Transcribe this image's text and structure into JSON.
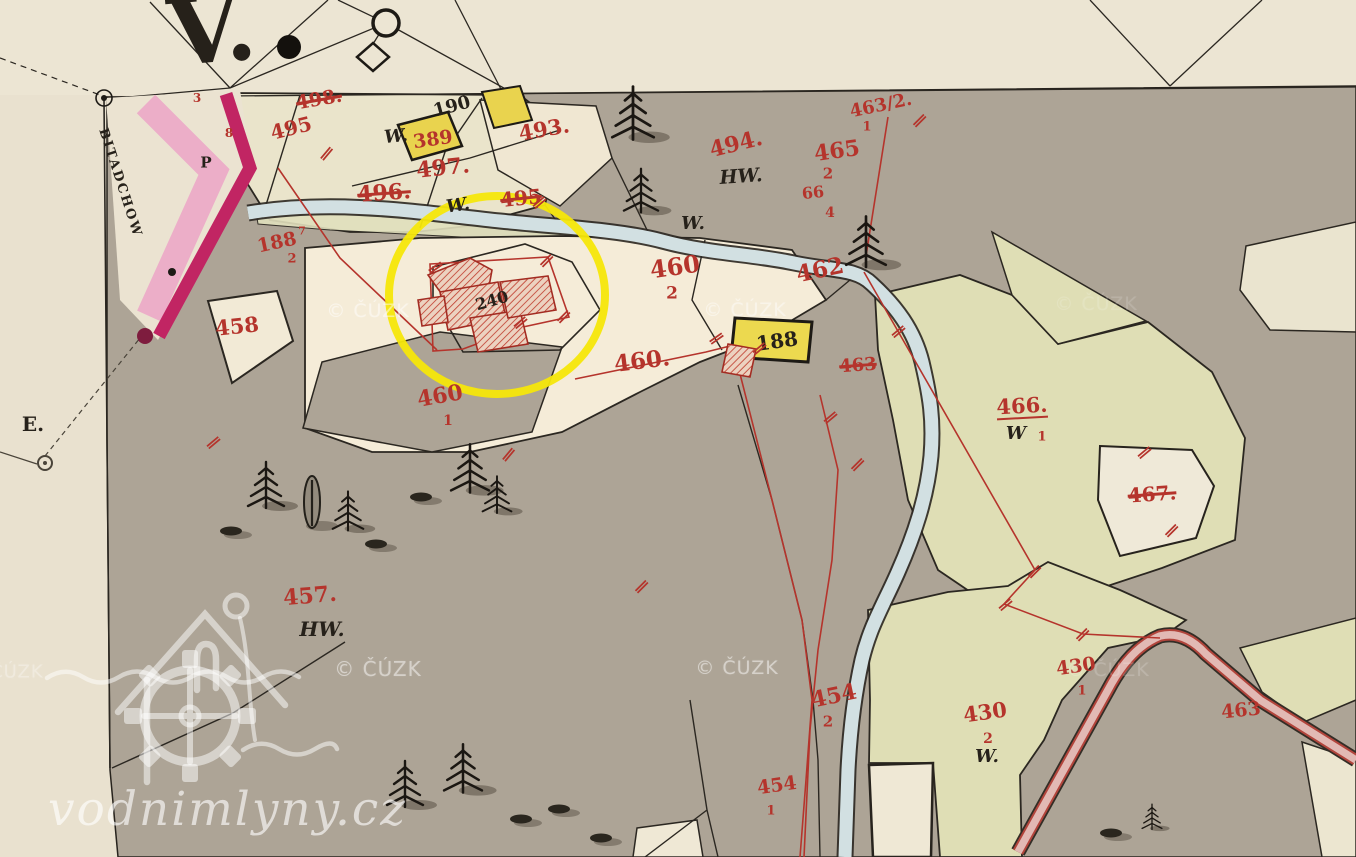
{
  "map": {
    "title": "historic cadastral map sheet",
    "palette": {
      "paper": "#e9e1cf",
      "forest_gray": "#ada496",
      "parcel_cream": "#f5ecd8",
      "parcel_olive": "#dfdeb5",
      "stream_blue": "#d2e0e2",
      "road_pink": "#ecaec8",
      "road_magenta": "#c12563",
      "building_yellow": "#e9d34e",
      "ink_red": "#b5342c",
      "ink_black": "#26211a",
      "highlight_yellow": "#f6e70a"
    },
    "highlight_circle": {
      "cx": 497,
      "cy": 295,
      "rx": 108,
      "ry": 99
    },
    "watermarks": {
      "cuzk_text": "© ČÚZK",
      "site": "vodnimlyny.cz",
      "cuzk_positions": [
        {
          "x": 368,
          "y": 311,
          "o": 0.5,
          "s": 19
        },
        {
          "x": 745,
          "y": 310,
          "o": 0.45,
          "s": 19
        },
        {
          "x": 1096,
          "y": 304,
          "o": 0.15,
          "s": 19
        },
        {
          "x": 378,
          "y": 669,
          "o": 0.5,
          "s": 20
        },
        {
          "x": 737,
          "y": 668,
          "o": 0.5,
          "s": 19
        },
        {
          "x": 1108,
          "y": 670,
          "o": 0.18,
          "s": 19
        },
        {
          "x": 4,
          "y": 672,
          "o": 0.32,
          "s": 18
        }
      ]
    },
    "labels": [
      {
        "name": "v-mark",
        "text": "V.",
        "x": 212,
        "y": 30,
        "s": 92,
        "r": -5,
        "c": "black"
      },
      {
        "name": "street-name",
        "text": "BITADCHOW",
        "x": 120,
        "y": 183,
        "s": 13,
        "r": 72,
        "c": "black",
        "sp": 2
      },
      {
        "name": "e-mark",
        "text": "E.",
        "x": 33,
        "y": 424,
        "s": 20,
        "r": 0,
        "c": "black"
      },
      {
        "name": "p-mark",
        "text": "P",
        "x": 206,
        "y": 163,
        "s": 15,
        "r": 0,
        "c": "black"
      },
      {
        "name": "parcel-498",
        "text": "498.",
        "x": 319,
        "y": 100,
        "s": 19,
        "r": -10,
        "c": "red",
        "struck": true
      },
      {
        "name": "parcel-495a",
        "text": "495",
        "x": 291,
        "y": 128,
        "s": 20,
        "r": -14,
        "c": "red"
      },
      {
        "name": "mark-3",
        "text": "3",
        "x": 197,
        "y": 98,
        "s": 12,
        "r": 0,
        "c": "red"
      },
      {
        "name": "mark-8",
        "text": "8",
        "x": 229,
        "y": 133,
        "s": 12,
        "r": 0,
        "c": "red"
      },
      {
        "name": "parcel-190",
        "text": "190",
        "x": 452,
        "y": 107,
        "s": 18,
        "r": -15,
        "c": "black"
      },
      {
        "name": "w-389",
        "text": "W.",
        "x": 396,
        "y": 137,
        "s": 18,
        "r": -5,
        "c": "black",
        "it": true
      },
      {
        "name": "parcel-389",
        "text": "389",
        "x": 433,
        "y": 140,
        "s": 19,
        "r": -8,
        "c": "red"
      },
      {
        "name": "parcel-493",
        "text": "493.",
        "x": 544,
        "y": 129,
        "s": 21,
        "r": -10,
        "c": "red"
      },
      {
        "name": "parcel-497",
        "text": "497.",
        "x": 443,
        "y": 168,
        "s": 22,
        "r": -6,
        "c": "red"
      },
      {
        "name": "parcel-496",
        "text": "496.",
        "x": 384,
        "y": 193,
        "s": 22,
        "r": -4,
        "c": "red",
        "struck": true
      },
      {
        "name": "w-north",
        "text": "W.",
        "x": 458,
        "y": 206,
        "s": 18,
        "r": -8,
        "c": "black",
        "it": true
      },
      {
        "name": "parcel-495b",
        "text": "495",
        "x": 521,
        "y": 198,
        "s": 20,
        "r": -6,
        "c": "red",
        "struck": true
      },
      {
        "name": "parcel-494",
        "text": "494.",
        "x": 736,
        "y": 144,
        "s": 22,
        "r": -14,
        "c": "red"
      },
      {
        "name": "hw-north",
        "text": "HW.",
        "x": 741,
        "y": 177,
        "s": 19,
        "r": -4,
        "c": "black",
        "it": true
      },
      {
        "name": "parcel-463-2",
        "text": "463/2.",
        "x": 881,
        "y": 106,
        "s": 18,
        "r": -12,
        "c": "red"
      },
      {
        "name": "parcel-463-2-sub",
        "text": "1",
        "x": 867,
        "y": 127,
        "s": 13,
        "r": 0,
        "c": "red"
      },
      {
        "name": "parcel-465",
        "text": "465",
        "x": 837,
        "y": 151,
        "s": 22,
        "r": -8,
        "c": "red"
      },
      {
        "name": "parcel-465-sub",
        "text": "2",
        "x": 828,
        "y": 174,
        "s": 15,
        "r": 0,
        "c": "red"
      },
      {
        "name": "parcel-66",
        "text": "66",
        "x": 813,
        "y": 193,
        "s": 16,
        "r": -6,
        "c": "red"
      },
      {
        "name": "parcel-66-sub",
        "text": "4",
        "x": 830,
        "y": 213,
        "s": 14,
        "r": 0,
        "c": "red"
      },
      {
        "name": "w-mid",
        "text": "W.",
        "x": 693,
        "y": 224,
        "s": 18,
        "r": 0,
        "c": "black",
        "it": true
      },
      {
        "name": "parcel-460-2",
        "text": "460",
        "x": 675,
        "y": 267,
        "s": 24,
        "r": -8,
        "c": "red"
      },
      {
        "name": "parcel-460-2-sub",
        "text": "2",
        "x": 672,
        "y": 294,
        "s": 17,
        "r": 0,
        "c": "red"
      },
      {
        "name": "parcel-462",
        "text": "462",
        "x": 820,
        "y": 270,
        "s": 23,
        "r": -12,
        "c": "red"
      },
      {
        "name": "house-240",
        "text": "240",
        "x": 492,
        "y": 301,
        "s": 16,
        "r": -16,
        "c": "black"
      },
      {
        "name": "parcel-188-2",
        "text": "188",
        "x": 277,
        "y": 243,
        "s": 19,
        "r": -12,
        "c": "red"
      },
      {
        "name": "parcel-188-2-sup",
        "text": "7",
        "x": 302,
        "y": 231,
        "s": 11,
        "r": 0,
        "c": "red"
      },
      {
        "name": "parcel-188-2-sub",
        "text": "2",
        "x": 292,
        "y": 259,
        "s": 13,
        "r": 0,
        "c": "red"
      },
      {
        "name": "parcel-458",
        "text": "458",
        "x": 237,
        "y": 326,
        "s": 21,
        "r": -6,
        "c": "red"
      },
      {
        "name": "parcel-460",
        "text": "460.",
        "x": 642,
        "y": 361,
        "s": 23,
        "r": -7,
        "c": "red"
      },
      {
        "name": "parcel-460-1",
        "text": "460",
        "x": 440,
        "y": 396,
        "s": 22,
        "r": -10,
        "c": "red"
      },
      {
        "name": "parcel-460-1-sub",
        "text": "1",
        "x": 448,
        "y": 421,
        "s": 14,
        "r": 0,
        "c": "red"
      },
      {
        "name": "building-188",
        "text": "188",
        "x": 777,
        "y": 341,
        "s": 20,
        "r": -8,
        "c": "black"
      },
      {
        "name": "parcel-463-struck",
        "text": "463",
        "x": 858,
        "y": 366,
        "s": 18,
        "r": -4,
        "c": "red",
        "struck": true
      },
      {
        "name": "parcel-466",
        "text": "466.",
        "x": 1022,
        "y": 407,
        "s": 21,
        "r": -3,
        "c": "red",
        "ul": true
      },
      {
        "name": "parcel-466-w",
        "text": "W",
        "x": 1016,
        "y": 434,
        "s": 18,
        "r": 0,
        "c": "black",
        "it": true
      },
      {
        "name": "parcel-466-sub",
        "text": "1",
        "x": 1042,
        "y": 437,
        "s": 13,
        "r": 0,
        "c": "red"
      },
      {
        "name": "parcel-467",
        "text": "467.",
        "x": 1152,
        "y": 494,
        "s": 20,
        "r": -4,
        "c": "red",
        "struck": true
      },
      {
        "name": "parcel-457",
        "text": "457.",
        "x": 310,
        "y": 596,
        "s": 22,
        "r": -5,
        "c": "red"
      },
      {
        "name": "hw-south",
        "text": "HW.",
        "x": 322,
        "y": 629,
        "s": 20,
        "r": 0,
        "c": "black",
        "it": true
      },
      {
        "name": "parcel-454-2",
        "text": "454",
        "x": 834,
        "y": 696,
        "s": 22,
        "r": -12,
        "c": "red"
      },
      {
        "name": "parcel-454-2-sub",
        "text": "2",
        "x": 828,
        "y": 722,
        "s": 15,
        "r": 0,
        "c": "red"
      },
      {
        "name": "parcel-430-2",
        "text": "430",
        "x": 985,
        "y": 712,
        "s": 21,
        "r": -8,
        "c": "red"
      },
      {
        "name": "parcel-430-2-sub",
        "text": "2",
        "x": 988,
        "y": 739,
        "s": 14,
        "r": 0,
        "c": "red"
      },
      {
        "name": "w-southeast",
        "text": "W.",
        "x": 987,
        "y": 757,
        "s": 18,
        "r": 0,
        "c": "black",
        "it": true
      },
      {
        "name": "parcel-430-1",
        "text": "430",
        "x": 1076,
        "y": 667,
        "s": 19,
        "r": -8,
        "c": "red"
      },
      {
        "name": "parcel-430-1-sub",
        "text": "1",
        "x": 1082,
        "y": 691,
        "s": 13,
        "r": 0,
        "c": "red"
      },
      {
        "name": "parcel-463-se",
        "text": "463",
        "x": 1241,
        "y": 711,
        "s": 19,
        "r": -6,
        "c": "red"
      },
      {
        "name": "parcel-454-1",
        "text": "454",
        "x": 777,
        "y": 786,
        "s": 19,
        "r": -8,
        "c": "red"
      },
      {
        "name": "parcel-454-1-sub",
        "text": "1",
        "x": 771,
        "y": 811,
        "s": 13,
        "r": 0,
        "c": "red"
      }
    ],
    "boundary_marks": [
      [
        327,
        153,
        40
      ],
      [
        540,
        202,
        50
      ],
      [
        436,
        267,
        55
      ],
      [
        547,
        260,
        45
      ],
      [
        521,
        322,
        50
      ],
      [
        564,
        316,
        45
      ],
      [
        214,
        442,
        50
      ],
      [
        509,
        454,
        40
      ],
      [
        717,
        338,
        55
      ],
      [
        920,
        120,
        45
      ],
      [
        831,
        417,
        50
      ],
      [
        858,
        464,
        45
      ],
      [
        899,
        331,
        50
      ],
      [
        1035,
        571,
        45
      ],
      [
        1006,
        604,
        50
      ],
      [
        1083,
        634,
        45
      ],
      [
        1145,
        452,
        50
      ],
      [
        1172,
        530,
        45
      ],
      [
        760,
        348,
        50
      ],
      [
        642,
        586,
        45
      ]
    ]
  }
}
